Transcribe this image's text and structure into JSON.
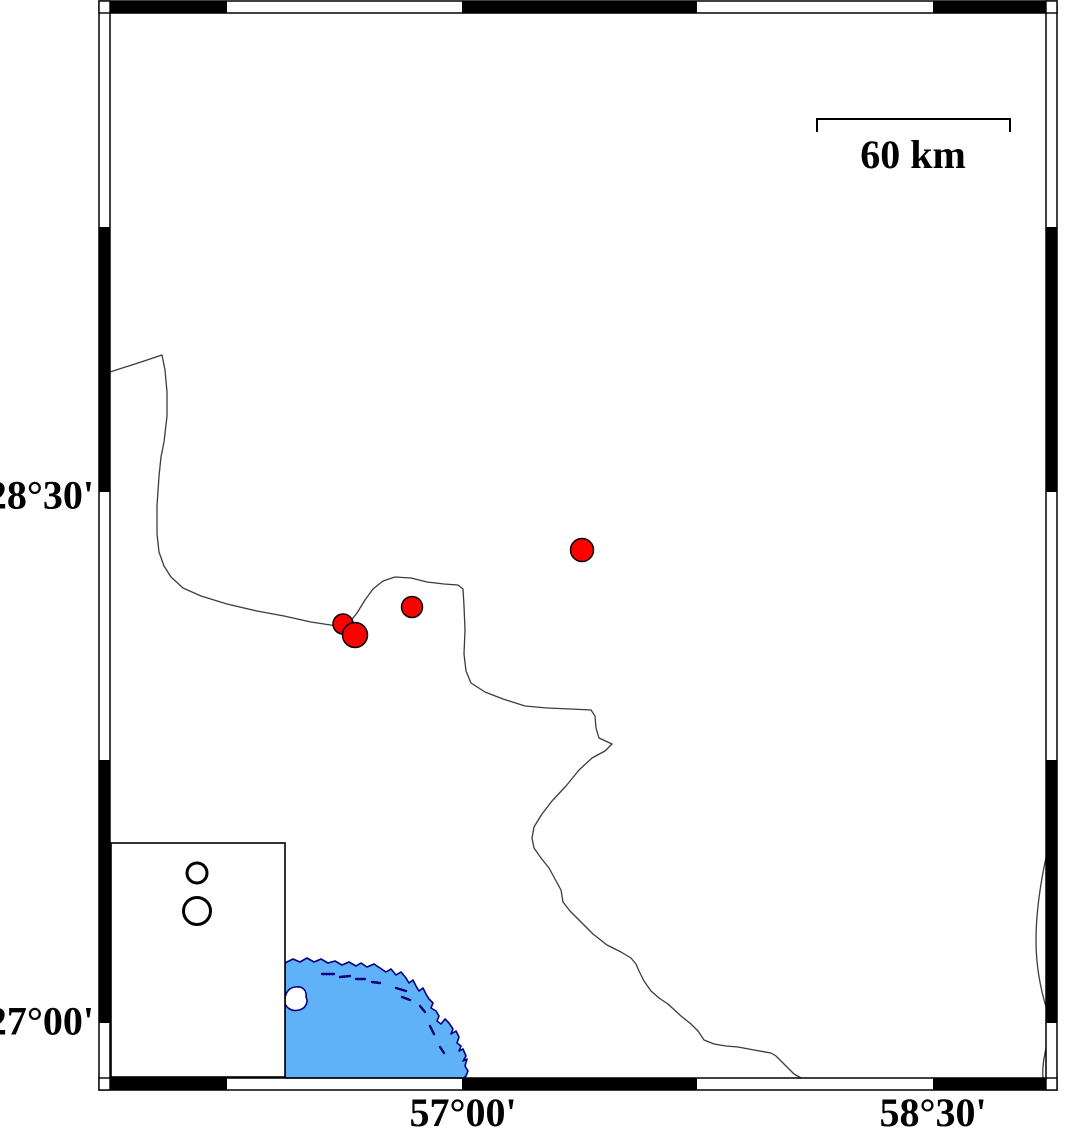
{
  "map": {
    "description": "epicenter-location-map",
    "axis_labels": {
      "lat": [
        {
          "text": "28°30'",
          "y": 497
        },
        {
          "text": "27°00'",
          "y": 1023
        }
      ],
      "lon": [
        {
          "text": "57°00'",
          "x": 463
        },
        {
          "text": "58°30'",
          "x": 933
        }
      ],
      "right_edge_x": 94,
      "bottom_top_y": 1093
    },
    "scale_bar": {
      "label": "60 km",
      "x1": 817,
      "x2": 1010,
      "y": 119,
      "drop": 13,
      "label_x": 913,
      "label_y": 135
    },
    "frame": {
      "outer": {
        "x": 99,
        "y": 1,
        "w": 958,
        "h": 1089
      },
      "inner": {
        "x": 110,
        "y": 13,
        "w": 936,
        "h": 1065
      },
      "top_black": [
        [
          110,
          227
        ],
        [
          462,
          697
        ],
        [
          933,
          1046
        ]
      ],
      "bottom_black": [
        [
          110,
          227
        ],
        [
          462,
          697
        ],
        [
          933,
          1046
        ]
      ],
      "left_black": [
        [
          227,
          492
        ],
        [
          760,
          1023
        ]
      ],
      "right_black": [
        [
          227,
          492
        ],
        [
          760,
          1023
        ]
      ]
    },
    "epicenters": [
      {
        "x": 582,
        "y": 550,
        "r": 11.5
      },
      {
        "x": 412,
        "y": 607,
        "r": 10.5
      },
      {
        "x": 343,
        "y": 624,
        "r": 10
      },
      {
        "x": 355,
        "y": 635,
        "r": 12.5
      }
    ],
    "legend": {
      "box": {
        "x": 111,
        "y": 843,
        "w": 174,
        "h": 234
      },
      "symbols": [
        {
          "cx": 197,
          "cy": 873,
          "r": 10
        },
        {
          "cx": 197,
          "cy": 911,
          "r": 13.5
        }
      ]
    },
    "coast": {
      "mainland_border": "M 110 372 L 138 363 L 162 355 L 165 370 L 167 392 L 167 416 L 164 442 L 161 457 L 159 476 L 157 506 L 157 534 L 159 552 L 164 566 L 171 577 L 183 588 L 201 596 L 227 604 L 257 611 L 284 616 L 311 622 L 337 626 L 349 623 L 357 613 L 365 600 L 373 589 L 383 581 L 395 577 L 411 578 L 427 582 L 444 584 L 458 585 L 463 589 L 464 606 L 465 630 L 464 654 L 466 671 L 471 683 L 485 692 L 503 699 L 525 706 L 547 708 L 571 709 L 591 710 L 595 716 L 596 728 L 599 738 L 612 744 L 605 751 L 592 758 L 579 770 L 566 786 L 552 801 L 542 814 L 534 827 L 532 838 L 534 848 L 541 858 L 549 868 L 555 879 L 561 890 L 563 902 L 570 911 L 582 923 L 593 934 L 607 945 L 621 952 L 631 958 L 636 964 L 639 971 L 644 981 L 651 991 L 659 998 L 668 1004 L 681 1016 L 691 1024 L 698 1031 L 704 1040 L 714 1044 L 726 1046 L 738 1047 L 754 1050 L 771 1053 L 776 1056 L 784 1064 L 794 1074 L 801 1078",
      "right_border_segments": [
        "M 1047 853 C 1041 880 1036 910 1036 940 C 1036 968 1041 991 1047 1010",
        "M 1046 1048 C 1044 1058 1042 1068 1043 1078"
      ],
      "sea_polygon": "M 285 963 L 293 959 L 300 962 L 307 958 L 314 962 L 321 959 L 328 963 L 335 961 L 342 965 L 349 962 L 356 966 L 361 963 L 367 967 L 374 964 L 380 968 L 386 972 L 391 969 L 396 975 L 401 972 L 406 978 L 409 983 L 413 980 L 416 986 L 419 991 L 423 988 L 426 994 L 429 999 L 433 1003 L 431 1008 L 436 1011 L 439 1016 L 437 1021 L 441 1024 L 445 1019 L 449 1023 L 453 1029 L 451 1034 L 456 1031 L 459 1037 L 457 1043 L 461 1046 L 459 1051 L 463 1049 L 466 1056 L 463 1061 L 467 1059 L 465 1066 L 468 1071 L 466 1076 L 464 1078 L 285 1078 Z",
      "island": "M 285 1000 C 285 992 290 987 296 987 C 303 986 307 991 306 997 C 309 1002 305 1009 299 1010 C 292 1012 287 1008 285 1004 Z",
      "sea_dashes": [
        "M 322 974 L 334 974",
        "M 340 977 L 350 976",
        "M 356 979 L 365 979",
        "M 372 982 L 380 983",
        "M 396 988 L 406 991",
        "M 402 997 L 410 1000",
        "M 420 1006 L 425 1012",
        "M 430 1026 L 434 1034",
        "M 440 1047 L 444 1053"
      ]
    },
    "colors": {
      "sea": "#5FB2F7",
      "coast_outline": "#000080",
      "border_line": "#3C3C3C",
      "epicenter_fill": "#FF0000",
      "frame": "#000000",
      "background": "#FFFFFF"
    }
  }
}
